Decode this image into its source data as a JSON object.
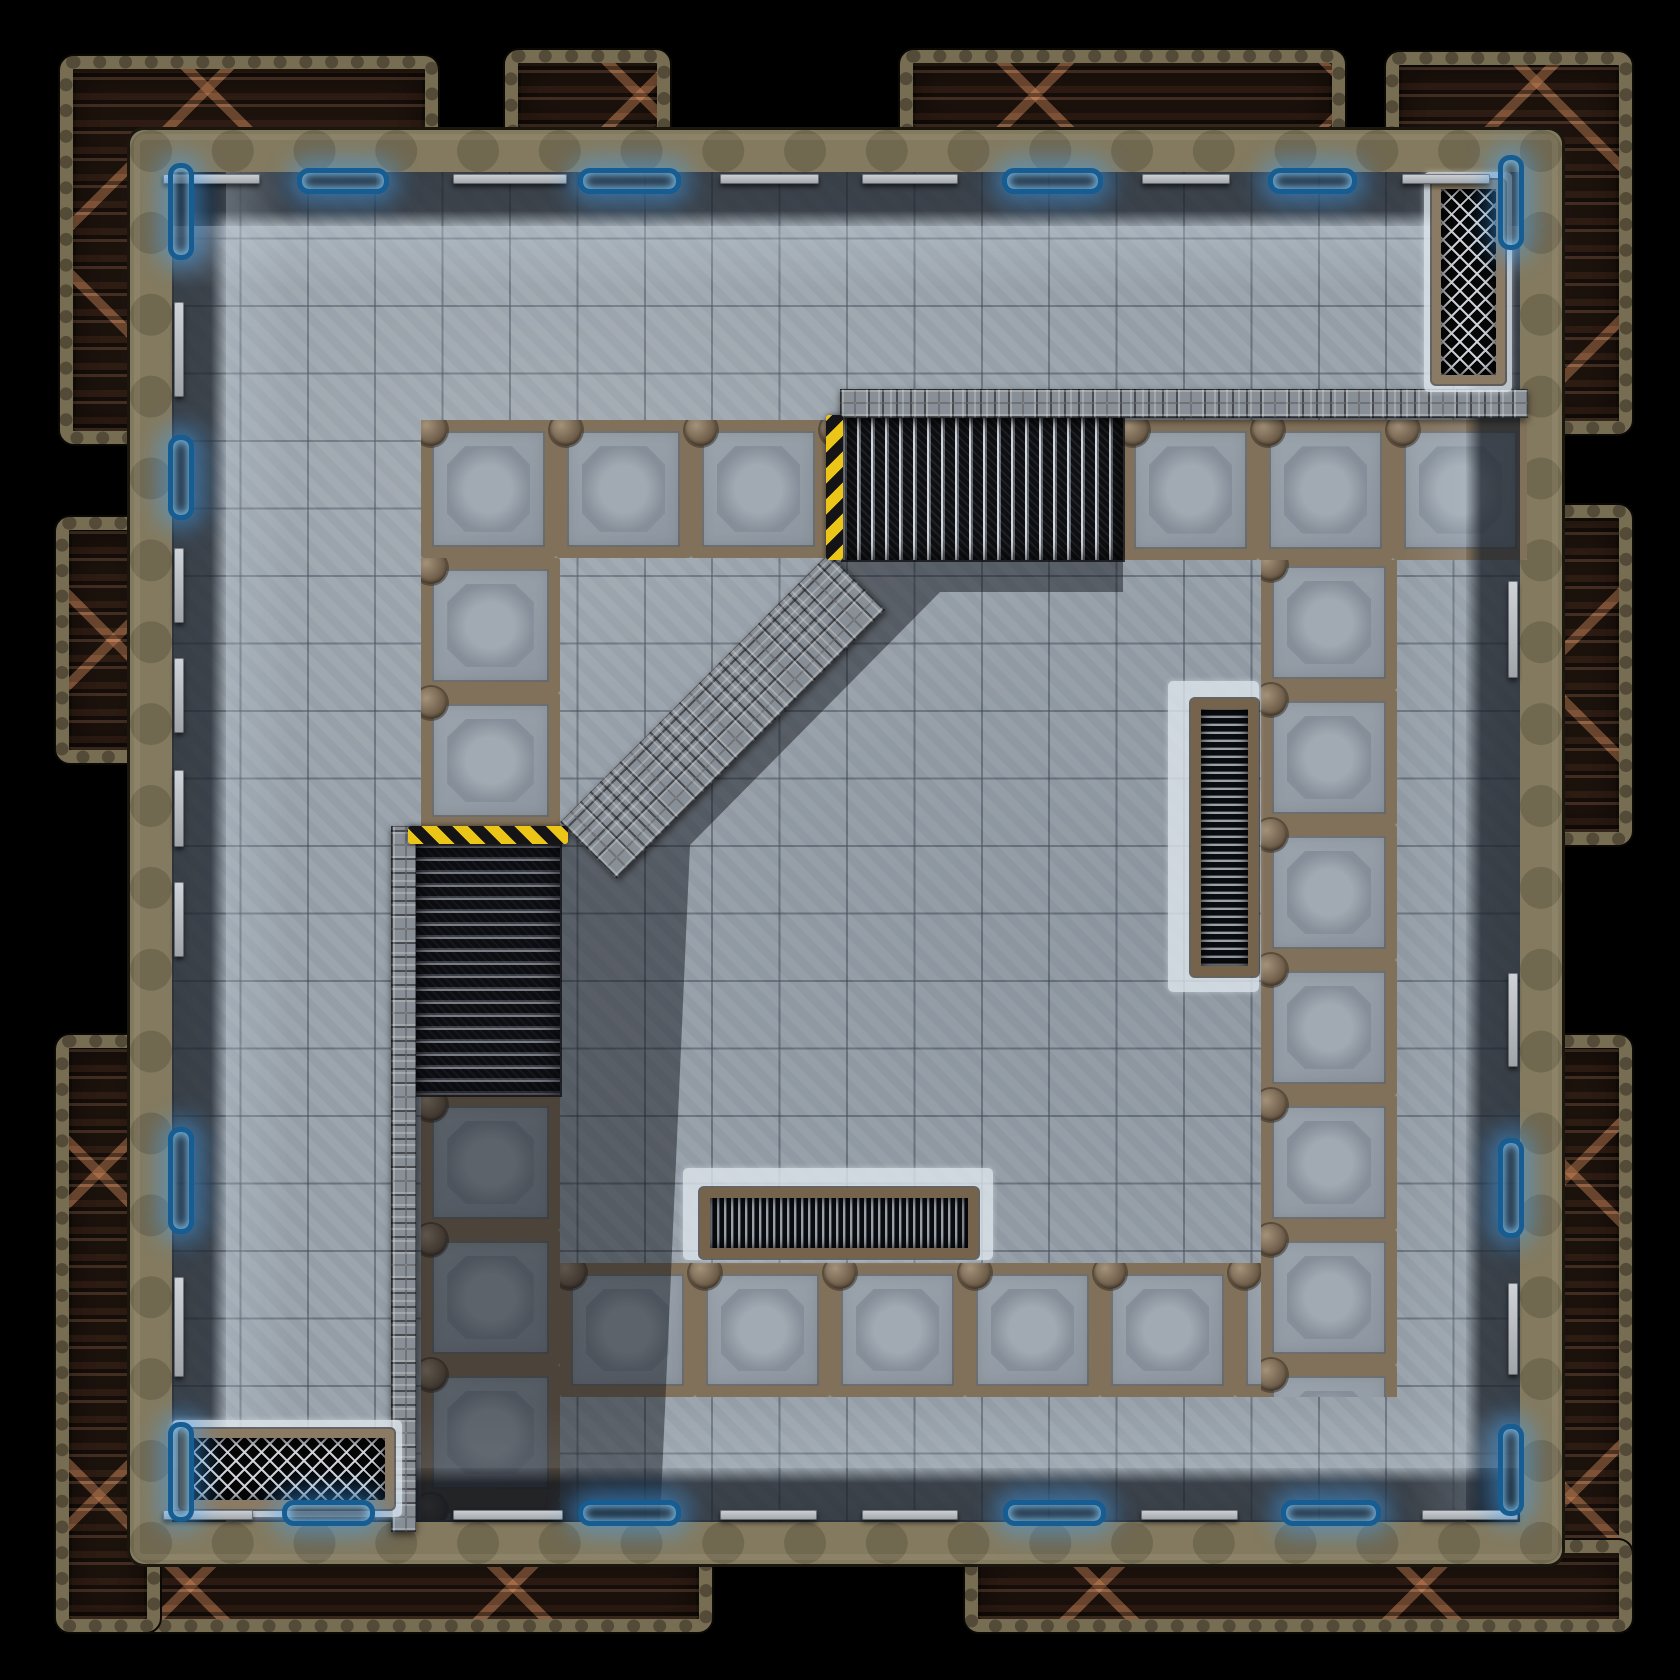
{
  "scene": {
    "kind": "sci-fi dungeon battlemap tile, top-down",
    "width": 1680,
    "height": 1680,
    "background": "#000000",
    "grid": {
      "pitch_px": 67.4,
      "columns": 20,
      "rows": 20,
      "line_color": "#3e4854"
    }
  },
  "palette": {
    "floor_concrete": "#99a2ab",
    "wall_khaki": "#847a5f",
    "truss_trim": "#776d53",
    "truss_rust_interior": "#241710",
    "truss_brace_rust": "#cd875a",
    "walkway_frame_rust": "#82715a",
    "walkway_panel": "#9ba4ad",
    "stud_metal": "#898f96",
    "grate_black": "#0e0f12",
    "grate_slat": "#e8edf2",
    "hazard_yellow": "#ecc519",
    "hazard_black": "#141416",
    "neon_blue": "#40a8ff",
    "neon_border": "#155d92",
    "wall_bar_gray": "#d0d4d8",
    "vent_frame_rust": "#75634c",
    "mesh_silver": "#d6d9de",
    "glow_concrete": "#dee6ee",
    "shadow": "rgba(10,14,19,0.45)"
  },
  "room": {
    "x": 130,
    "y": 130,
    "w": 1432,
    "h": 1434,
    "wall_thickness": 42
  },
  "floor": {
    "x": 172,
    "y": 172,
    "w": 1348,
    "h": 1350
  },
  "edge_bands": {
    "dark_width": 54,
    "light_width": 62
  },
  "trusses": [
    {
      "x": 60,
      "y": 56,
      "w": 378,
      "h": 388,
      "side": "top-left-corner"
    },
    {
      "x": 505,
      "y": 50,
      "w": 165,
      "h": 90,
      "side": "top-tab-1"
    },
    {
      "x": 900,
      "y": 50,
      "w": 445,
      "h": 90,
      "side": "top-tab-2"
    },
    {
      "x": 1386,
      "y": 52,
      "w": 246,
      "h": 382,
      "side": "top-right-corner"
    },
    {
      "x": 1528,
      "y": 505,
      "w": 104,
      "h": 340,
      "side": "right-middle"
    },
    {
      "x": 1528,
      "y": 1035,
      "w": 104,
      "h": 597,
      "side": "right-bottom"
    },
    {
      "x": 965,
      "y": 1540,
      "w": 667,
      "h": 92,
      "side": "bottom-right"
    },
    {
      "x": 56,
      "y": 1540,
      "w": 656,
      "h": 92,
      "side": "bottom-left"
    },
    {
      "x": 56,
      "y": 1035,
      "w": 104,
      "h": 597,
      "side": "left-bottom"
    },
    {
      "x": 56,
      "y": 517,
      "w": 104,
      "h": 246,
      "side": "left-middle"
    }
  ],
  "walkways": [
    {
      "x": 421,
      "y": 420,
      "w": 419,
      "h": 138,
      "dir": "h",
      "note": "upper-left row"
    },
    {
      "x": 421,
      "y": 558,
      "w": 139,
      "h": 268,
      "dir": "v",
      "note": "left column upper"
    },
    {
      "x": 421,
      "y": 1095,
      "w": 139,
      "h": 425,
      "dir": "v",
      "note": "left column lower"
    },
    {
      "x": 560,
      "y": 1263,
      "w": 837,
      "h": 134,
      "dir": "h",
      "note": "bottom row"
    },
    {
      "x": 1261,
      "y": 420,
      "w": 136,
      "h": 977,
      "dir": "v",
      "note": "right column"
    },
    {
      "x": 1123,
      "y": 420,
      "w": 404,
      "h": 140,
      "dir": "h",
      "note": "upper-right row"
    }
  ],
  "panel_pitch": 135,
  "stairs": [
    {
      "x": 843,
      "y": 417,
      "w": 280,
      "h": 143,
      "dir": "v",
      "note": "upper grated ramp, descends west"
    },
    {
      "x": 416,
      "y": 844,
      "w": 144,
      "h": 251,
      "dir": "h",
      "note": "mid-left grated ramp, descends south"
    }
  ],
  "studded_strips": [
    {
      "x": 840,
      "y": 389,
      "w": 688,
      "h": 29,
      "rot": 0,
      "note": "upper platform edge"
    },
    {
      "x": 391,
      "y": 826,
      "w": 25,
      "h": 706,
      "rot": 0,
      "note": "left platform edge column"
    },
    {
      "x": 560,
      "y": 822,
      "w": 380,
      "h": 80,
      "rot": -45,
      "note": "diagonal ramp edge"
    }
  ],
  "hazard_strips": [
    {
      "x": 826,
      "y": 415,
      "w": 17,
      "h": 145,
      "dir": "v"
    },
    {
      "x": 408,
      "y": 826,
      "w": 160,
      "h": 18,
      "dir": "h"
    }
  ],
  "shadow_polygons": [
    {
      "points": "843,560 1123,560 1123,592 940,592 690,845 660,1522 391,1522 391,844 565,844 565,828 832,566"
    }
  ],
  "vents": [
    {
      "glow": {
        "x": 1168,
        "y": 681,
        "w": 91,
        "h": 311
      },
      "frame": {
        "x": 1191,
        "y": 699,
        "w": 67,
        "h": 277
      },
      "grate": {
        "x": 1201,
        "y": 709,
        "w": 47,
        "h": 257
      },
      "slats": "h"
    },
    {
      "glow": {
        "x": 683,
        "y": 1168,
        "w": 310,
        "h": 92
      },
      "frame": {
        "x": 700,
        "y": 1188,
        "w": 278,
        "h": 70
      },
      "grate": {
        "x": 710,
        "y": 1198,
        "w": 258,
        "h": 50
      },
      "slats": "v"
    }
  ],
  "mesh_grates": [
    {
      "glow": {
        "x": 1424,
        "y": 172,
        "w": 88,
        "h": 220
      },
      "frame": {
        "x": 1432,
        "y": 180,
        "w": 73,
        "h": 204
      },
      "mesh": {
        "x": 1441,
        "y": 189,
        "w": 55,
        "h": 186
      }
    },
    {
      "glow": {
        "x": 172,
        "y": 1420,
        "w": 230,
        "h": 97
      },
      "frame": {
        "x": 180,
        "y": 1429,
        "w": 214,
        "h": 80
      },
      "mesh": {
        "x": 189,
        "y": 1438,
        "w": 196,
        "h": 62
      }
    }
  ],
  "wall_features": {
    "top": [
      {
        "pos": 163,
        "len": 97,
        "type": "bar"
      },
      {
        "pos": 297,
        "len": 92,
        "type": "neon"
      },
      {
        "pos": 453,
        "len": 114,
        "type": "bar"
      },
      {
        "pos": 578,
        "len": 103,
        "type": "neon"
      },
      {
        "pos": 720,
        "len": 99,
        "type": "bar"
      },
      {
        "pos": 862,
        "len": 96,
        "type": "bar"
      },
      {
        "pos": 1002,
        "len": 101,
        "type": "neon"
      },
      {
        "pos": 1142,
        "len": 88,
        "type": "bar"
      },
      {
        "pos": 1268,
        "len": 89,
        "type": "neon"
      },
      {
        "pos": 1402,
        "len": 88,
        "type": "bar"
      }
    ],
    "bottom": [
      {
        "pos": 163,
        "len": 90,
        "type": "bar"
      },
      {
        "pos": 282,
        "len": 93,
        "type": "neon"
      },
      {
        "pos": 453,
        "len": 110,
        "type": "bar"
      },
      {
        "pos": 578,
        "len": 103,
        "type": "neon"
      },
      {
        "pos": 720,
        "len": 97,
        "type": "bar"
      },
      {
        "pos": 862,
        "len": 96,
        "type": "bar"
      },
      {
        "pos": 1003,
        "len": 103,
        "type": "neon"
      },
      {
        "pos": 1141,
        "len": 97,
        "type": "bar"
      },
      {
        "pos": 1281,
        "len": 100,
        "type": "neon"
      },
      {
        "pos": 1422,
        "len": 96,
        "type": "bar"
      }
    ],
    "left": [
      {
        "pos": 163,
        "len": 97,
        "type": "neon"
      },
      {
        "pos": 302,
        "len": 95,
        "type": "bar"
      },
      {
        "pos": 435,
        "len": 85,
        "type": "neon"
      },
      {
        "pos": 548,
        "len": 75,
        "type": "bar"
      },
      {
        "pos": 658,
        "len": 75,
        "type": "bar"
      },
      {
        "pos": 770,
        "len": 77,
        "type": "bar"
      },
      {
        "pos": 882,
        "len": 75,
        "type": "bar"
      },
      {
        "pos": 1127,
        "len": 107,
        "type": "neon"
      },
      {
        "pos": 1277,
        "len": 100,
        "type": "bar"
      },
      {
        "pos": 1422,
        "len": 100,
        "type": "neon"
      }
    ],
    "right": [
      {
        "pos": 155,
        "len": 95,
        "type": "neon"
      },
      {
        "pos": 581,
        "len": 97,
        "type": "bar"
      },
      {
        "pos": 973,
        "len": 94,
        "type": "bar"
      },
      {
        "pos": 1138,
        "len": 100,
        "type": "neon"
      },
      {
        "pos": 1283,
        "len": 92,
        "type": "bar"
      },
      {
        "pos": 1424,
        "len": 92,
        "type": "neon"
      }
    ]
  }
}
